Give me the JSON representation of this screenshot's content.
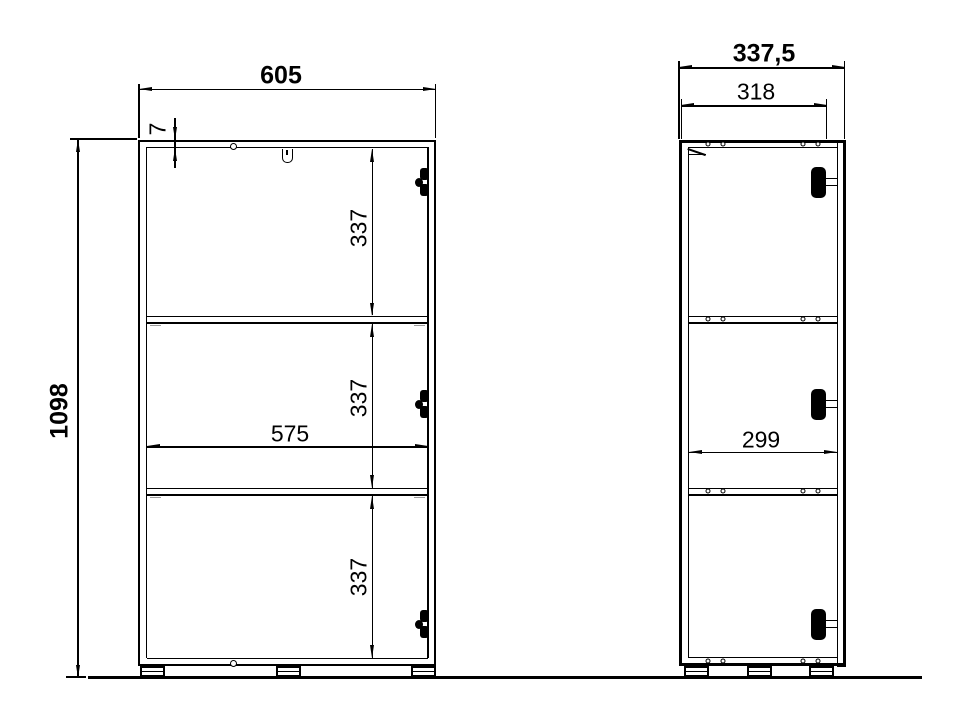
{
  "drawing": {
    "type": "furniture-dimension-diagram",
    "views": [
      "front",
      "side"
    ],
    "colors": {
      "line": "#000000",
      "background": "#ffffff",
      "tick": "#9a9a9a"
    }
  },
  "front_view": {
    "overall_width": "605",
    "overall_height": "1098",
    "top_thickness": "7",
    "inner_width": "575",
    "compartments": [
      "337",
      "337",
      "337"
    ]
  },
  "side_view": {
    "overall_depth": "337,5",
    "top_depth": "318",
    "inner_depth": "299"
  }
}
